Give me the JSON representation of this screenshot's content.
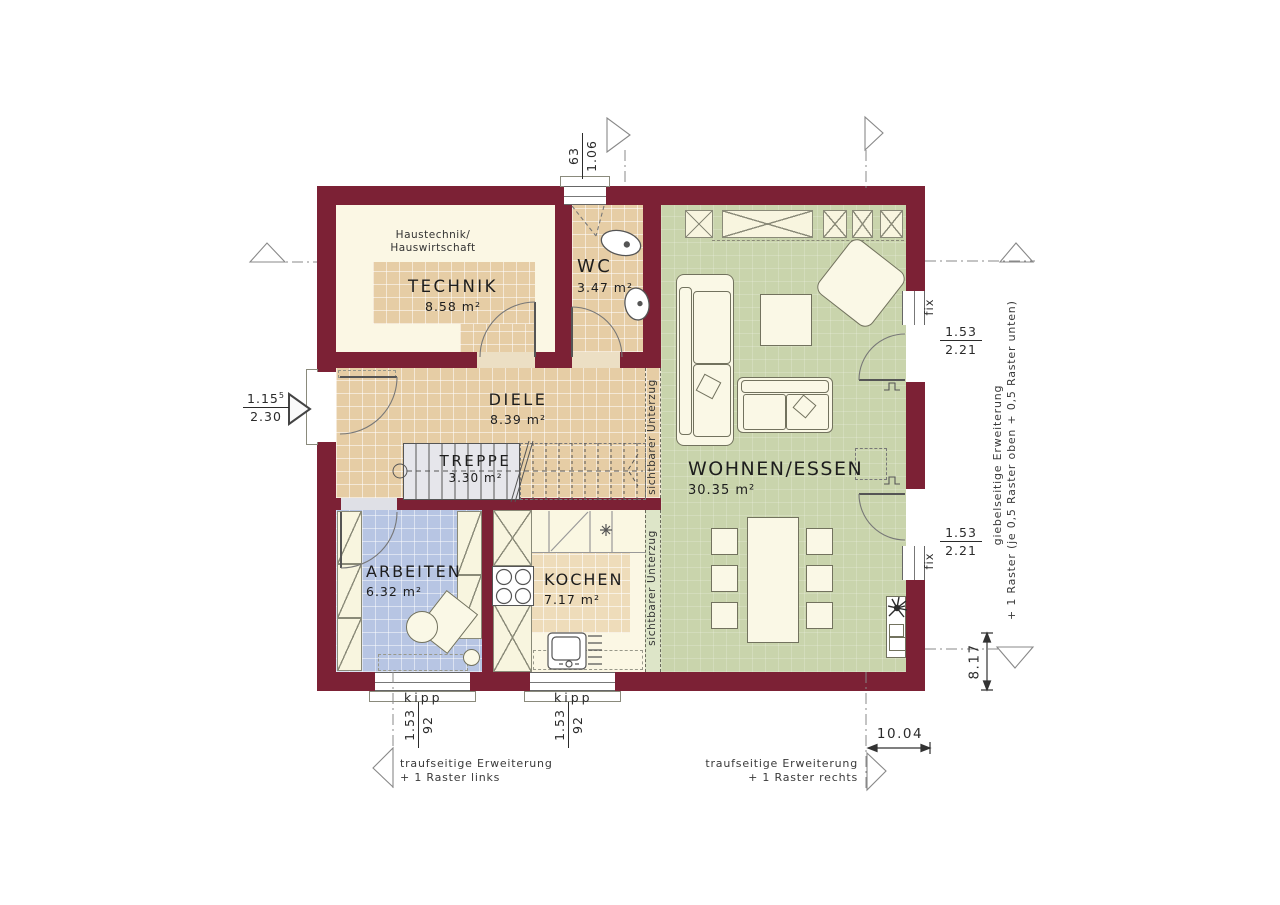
{
  "rooms": {
    "technik": {
      "name": "TECHNIK",
      "area": "8.58 m²",
      "note_line1": "Haustechnik/",
      "note_line2": "Hauswirtschaft"
    },
    "wc": {
      "name": "WC",
      "area": "3.47 m²"
    },
    "diele": {
      "name": "DIELE",
      "area": "8.39 m²"
    },
    "treppe": {
      "name": "TREPPE",
      "area": "3.30 m²"
    },
    "wohnen_essen": {
      "name": "WOHNEN/ESSEN",
      "area": "30.35 m²"
    },
    "arbeiten": {
      "name": "ARBEITEN",
      "area": "6.32 m²"
    },
    "kochen": {
      "name": "KOCHEN",
      "area": "7.17 m²"
    }
  },
  "dims": {
    "wc_window": {
      "top": "63",
      "bottom": "1.06"
    },
    "entrance": {
      "top": "1.15",
      "sup": "5",
      "bottom": "2.30"
    },
    "terrace_top": {
      "top": "1.53",
      "bottom": "2.21"
    },
    "terrace_bottom": {
      "top": "1.53",
      "bottom": "2.21"
    },
    "window_arbeiten": {
      "top": "1.53",
      "bottom": "92"
    },
    "window_kochen": {
      "top": "1.53",
      "bottom": "92"
    },
    "total_width": "10.04",
    "total_height": "8.17"
  },
  "labels": {
    "kipp_arbeiten": "kipp",
    "kipp_kochen": "kipp",
    "fix_top": "fix",
    "fix_bottom": "fix",
    "beam_top": "sichtbarer Unterzug",
    "beam_bottom": "sichtbarer Unterzug"
  },
  "extension_notes": {
    "gable_line1": "giebelseitige Erweiterung",
    "gable_line2": "+ 1 Raster (je 0,5 Raster oben + 0,5 Raster unten)",
    "eaves_left_line1": "traufseitige Erweiterung",
    "eaves_left_line2": "+ 1 Raster links",
    "eaves_right_line1": "traufseitige Erweiterung",
    "eaves_right_line2": "+ 1 Raster rechts"
  },
  "colors": {
    "wall": "#7c2135",
    "floor_tile": "#e6cda5",
    "floor_cream": "#fbf7e4",
    "floor_blue": "#b7c5e3",
    "floor_green": "#c9d4ac",
    "kitchen_tile": "#eedcba",
    "stairs": "#e6e6eb"
  }
}
